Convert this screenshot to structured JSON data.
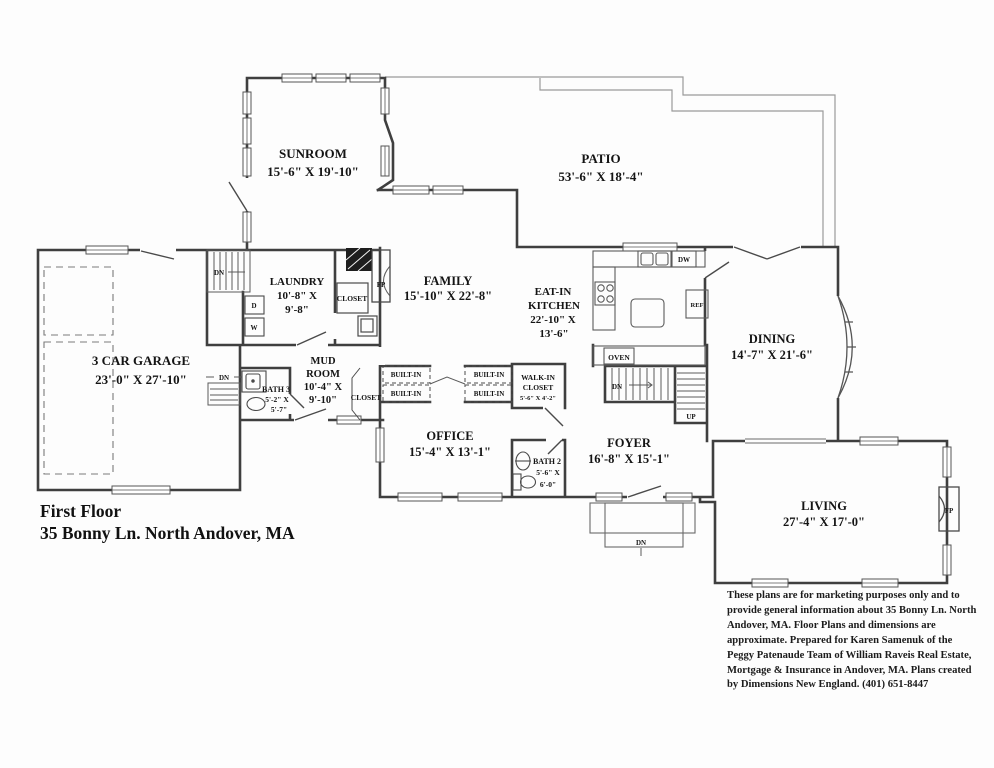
{
  "colors": {
    "wall": "#3f3f3f",
    "thin": "#666666",
    "patio_line": "#9a9a9a",
    "text": "#141414"
  },
  "title_block": {
    "line1": "First Floor",
    "line2": "35 Bonny Ln. North Andover, MA"
  },
  "disclaimer": "These plans are for marketing purposes only and to provide general information about 35 Bonny Ln. North Andover, MA.  Floor Plans and dimensions are approximate.  Prepared for Karen Samenuk of the Peggy Patenaude Team of William Raveis Real Estate, Mortgage & Insurance in Andover, MA.  Plans created by Dimensions New England.  (401) 651-8447",
  "rooms": {
    "sunroom": {
      "name": "SUNROOM",
      "dims": "15'-6\" X 19'-10\""
    },
    "patio": {
      "name": "PATIO",
      "dims": "53'-6\" X 18'-4\""
    },
    "garage": {
      "name": "3 CAR GARAGE",
      "dims": "23'-0\" X 27'-10\""
    },
    "laundry": {
      "name": "LAUNDRY",
      "dims1": "10'-8\" X",
      "dims2": "9'-8\""
    },
    "family": {
      "name": "FAMILY",
      "dims": "15'-10\" X 22'-8\""
    },
    "kitchen": {
      "name1": "EAT-IN",
      "name2": "KITCHEN",
      "dims1": "22'-10\" X",
      "dims2": "13'-6\""
    },
    "dining": {
      "name": "DINING",
      "dims": "14'-7\" X 21'-6\""
    },
    "mudroom": {
      "name1": "MUD",
      "name2": "ROOM",
      "dims1": "10'-4\" X",
      "dims2": "9'-10\""
    },
    "bath3": {
      "name": "BATH 3",
      "dims1": "5'-2\" X",
      "dims2": "5'-7\""
    },
    "office": {
      "name": "OFFICE",
      "dims": "15'-4\" X 13'-1\""
    },
    "foyer": {
      "name": "FOYER",
      "dims": "16'-8\" X 15'-1\""
    },
    "walkin": {
      "name1": "WALK-IN",
      "name2": "CLOSET",
      "dims": "5'-6\" X 4'-2\""
    },
    "bath2": {
      "name": "BATH 2",
      "dims1": "5'-6\" X",
      "dims2": "6'-0\""
    },
    "living": {
      "name": "LIVING",
      "dims": "27'-4\" X 17'-0\""
    }
  },
  "labels": {
    "builtin": "BUILT-IN",
    "closet": "CLOSET",
    "fireplace": "FP",
    "dishwasher": "DW",
    "refrigerator": "REF",
    "oven": "OVEN",
    "washer": "W",
    "dryer": "D",
    "down": "DN",
    "up": "UP"
  }
}
